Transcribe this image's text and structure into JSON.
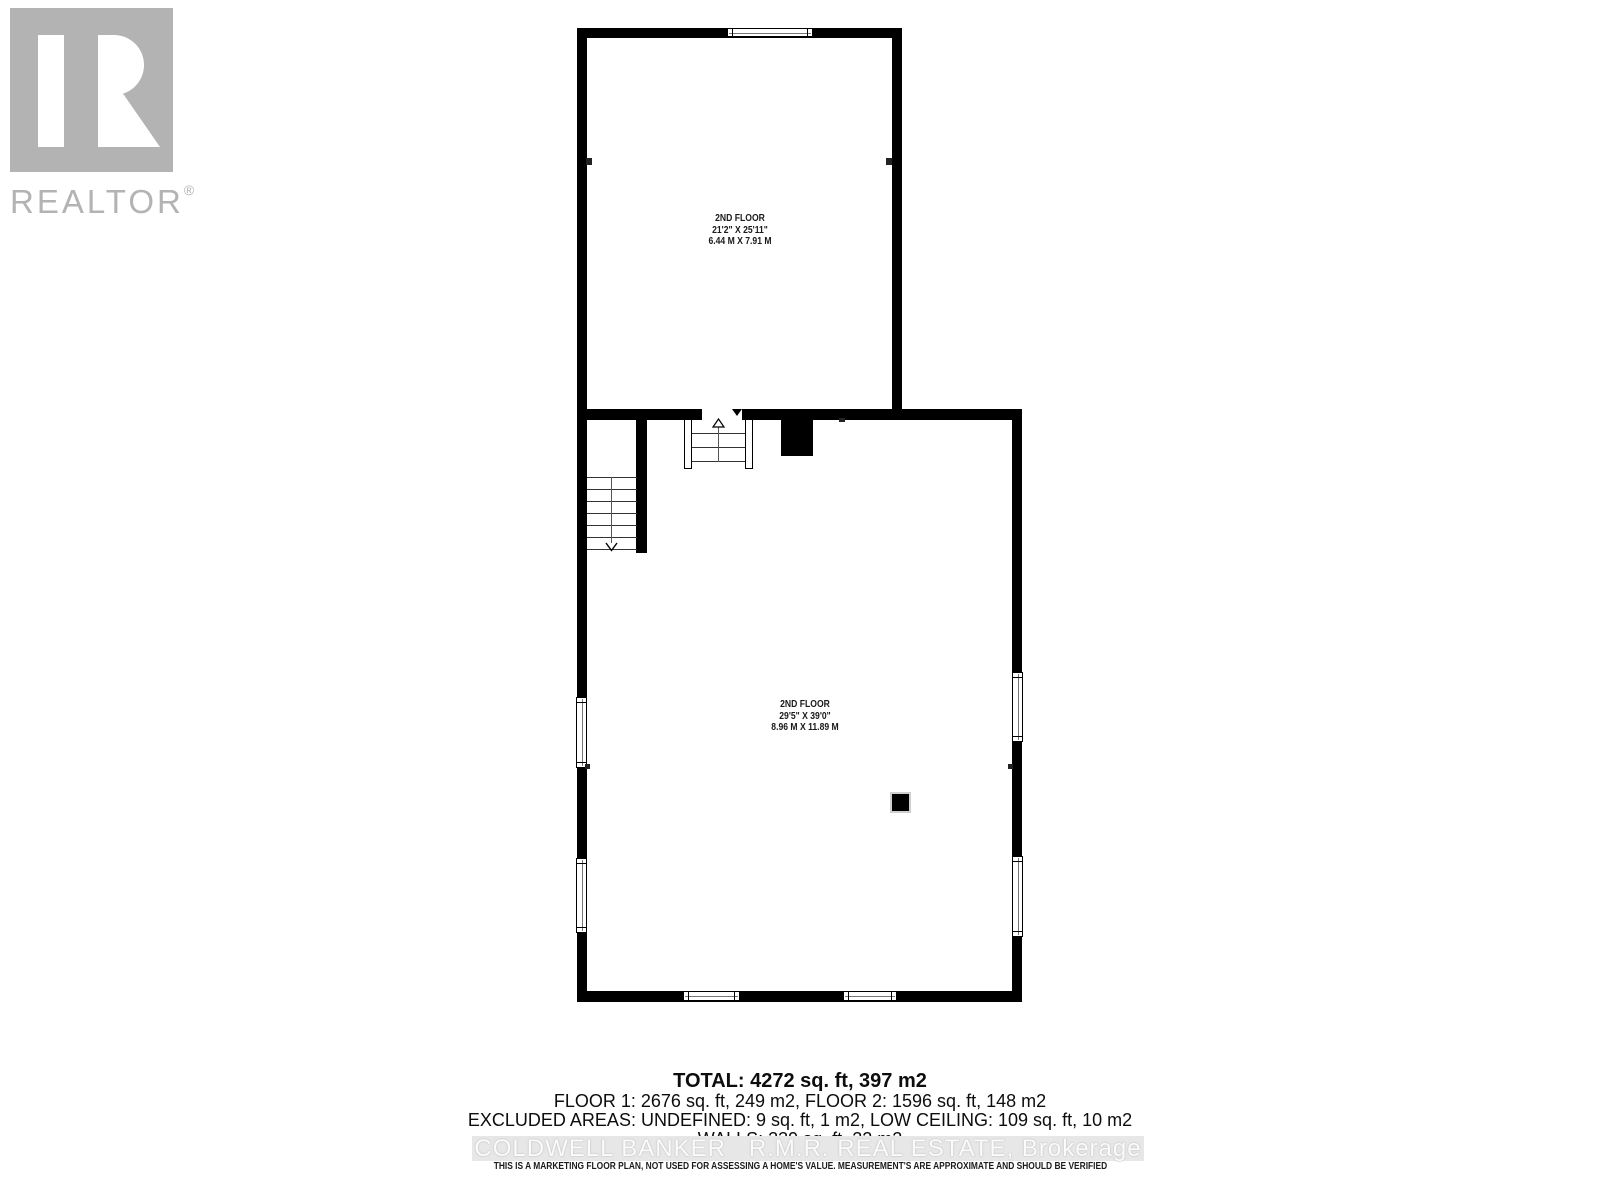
{
  "colors": {
    "wall": "#000000",
    "logo-gray": "#b3b3b3",
    "watermark-band": "#e7e7e7",
    "watermark-text": "#fbfbfb"
  },
  "branding": {
    "realtor": "REALTOR",
    "registered": "®"
  },
  "floor_plan": {
    "upper_room": {
      "name": "2ND FLOOR",
      "dimensions_imperial": "21'2\" X 25'11\"",
      "dimensions_metric": "6.44 M X 7.91 M"
    },
    "lower_room": {
      "name": "2ND FLOOR",
      "dimensions_imperial": "29'5\" X 39'0\"",
      "dimensions_metric": "8.96 M X 11.89 M"
    }
  },
  "summary": {
    "total": "TOTAL: 4272 sq. ft, 397 m2",
    "floor_breakdown": "FLOOR 1: 2676 sq. ft, 249 m2, FLOOR 2: 1596 sq. ft, 148 m2",
    "excluded_areas": "EXCLUDED AREAS: UNDEFINED: 9 sq. ft, 1 m2, LOW CEILING: 109 sq. ft, 10 m2",
    "walls": "WALLS: 239 sq. ft, 22 m2"
  },
  "watermark": "COLDWELL BANKER   R.M.R. REAL ESTATE, Brokerage",
  "disclaimer": "THIS IS A MARKETING FLOOR PLAN, NOT USED FOR ASSESSING A HOME'S VALUE. MEASUREMENT'S ARE APPROXIMATE AND SHOULD BE VERIFIED"
}
